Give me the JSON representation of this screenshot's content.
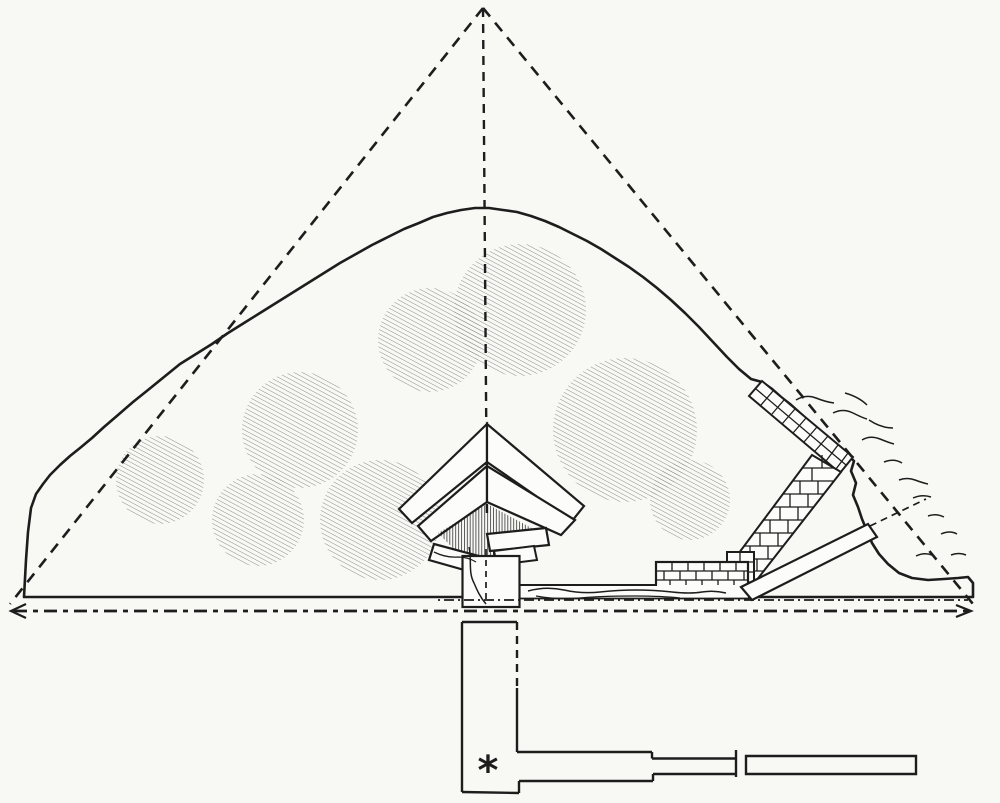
{
  "figure": {
    "marker_symbol": "*"
  },
  "colors": {
    "paper": "#f8f8f5",
    "ink": "#1d1d1d",
    "cut": "#fcfcfa"
  }
}
